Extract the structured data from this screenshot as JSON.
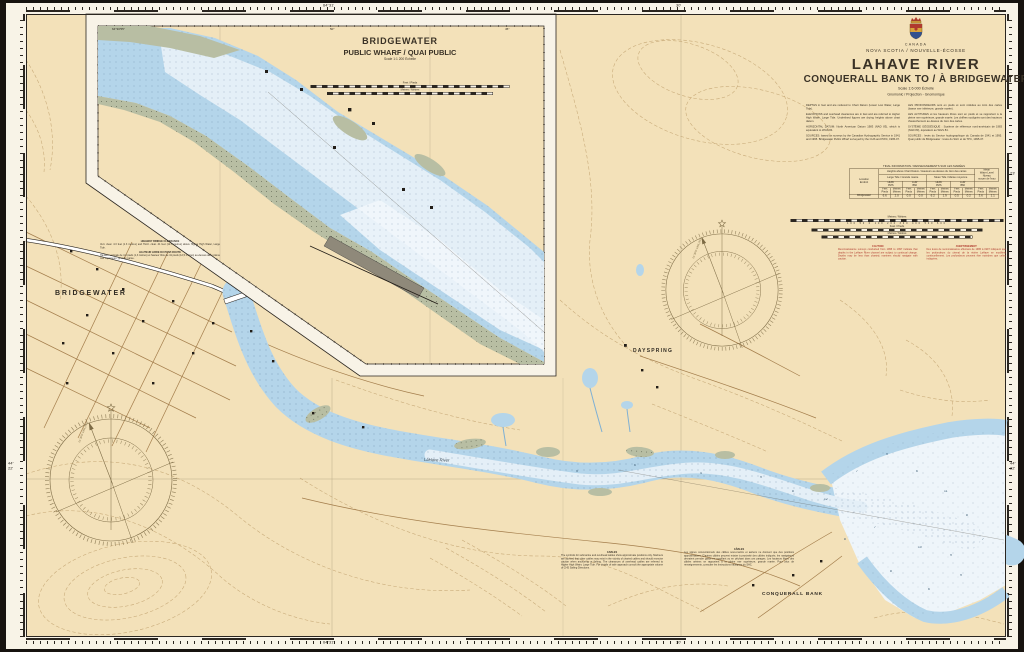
{
  "border": {
    "top_left_lon": "64°31'",
    "top_mid_lon": "30'",
    "bottom_left_lon": "64°31'",
    "bottom_mid_lon": "30'",
    "left_lat": "44°\n22'",
    "right_lat": "44°\n22'",
    "right_lat_upper": "23'"
  },
  "title_block": {
    "country": "CANADA",
    "region": "NOVA SCOTIA / NOUVELLE-ÉCOSSE",
    "title": "LAHAVE RIVER",
    "subtitle": "CONQUERALL BANK TO / À BRIDGEWATER",
    "scale": "Scale 1:6 000 Échelle",
    "projection": "Gnomonic / Projection - Gnomonique",
    "notes_en": [
      "DEPTHS in feet and are reduced to Chart Datum (Lower Low Water, Large Tide).",
      "ELEVATIONS and overhead clearances are in feet and are referred to Higher High Water, Large Tide. Underlined figures are drying heights above chart datum.",
      "HORIZONTAL DATUM: North American Datum 1983 (NAD 83), which is equivalent to WGS 84.",
      "SOURCES: based on surveys by the Canadian Hydrographic Service in 1941 and 1995. Bridgewater Public Wharf surveyed by the CHS and PWC, 1995-07."
    ],
    "notes_fr": [
      "LES PROFONDEURS sont en pieds et sont réduites au zéro des cartes (basse mer inférieure, grande marée).",
      "LES ALTITUDES et les hauteurs libres sont en pieds et se rapportent à la pleine mer supérieure, grande marée. Les chiffres soulignés sont des hauteurs d'assèchement au-dessus du zéro des cartes.",
      "SYSTÈME GÉODÉSIQUE : Système de référence nord-américain de 1983 (NAD 83), équivalent au WGS 84.",
      "SOURCES : levés du Service hydrographique du Canada de 1941 et 1995. Quai public de Bridgewater : levés du SHC et de TPC, 1995-07."
    ]
  },
  "tide": {
    "title": "TIDAL INFORMATION / RENSEIGNEMENTS SUR LES MARÉES",
    "location": "Location\nEndroit",
    "heights": "Heights above Chart Datum / Hauteurs au-dessus du zéro des cartes",
    "large": "Large Tide / Grande marée",
    "mean": "Mean Tide / Marée moyenne",
    "mwl": "Mean\nWater Level\nNiveau\nmoyen de l'eau",
    "hhw": "HHW\nPMS",
    "llw": "LLW\nBMI",
    "feet": "Feet\nPieds",
    "metres": "Metres\nMètres",
    "row": "Bridgewater",
    "values": [
      "6.6",
      "2.0",
      "0.0",
      "0.0",
      "6.2",
      "1.9",
      "0.5",
      "0.2",
      "3.6",
      "1.1"
    ]
  },
  "bars": {
    "b1_label": "Metres / Mètres",
    "b1_ticks": "100 50 0 100 200 300 400 500 600",
    "b2_label": "Feet / Pieds",
    "b2_ticks": "200 0 200 400 600 800 1000 1200 1400",
    "b3_label": "Metres / Mètres",
    "b3_ticks": "50 0 50 100 150 200 250 300"
  },
  "caution": {
    "en_title": "CAUTION",
    "en_body": "Reconnaissance surveys conducted from 1995 to 1997 indicate that depths in the LaHave River channel are subject to continual change. Depths may be less than charted; mariners should navigate with caution.",
    "fr_title": "AVERTISSEMENT",
    "fr_body": "Des levés de reconnaissance effectués de 1995 à 1997 indiquent que les profondeurs du chenal de la rivière LaHave se modifient continuellement. Les profondeurs peuvent être moindres que celles indiquées."
  },
  "cables": {
    "en_title": "CABLES",
    "en_body": "The symbols for submarine and overhead cables show approximate positions only. Mariners are advised that other cables may exist in the vicinity of charted cables and should exercise caution when anchoring or fishing. The clearances of overhead cables are referred to Higher High Water, Large Tide. For details of safe approach consult the appropriate volume of CHS Sailing Directions.",
    "fr_title": "CÂBLES",
    "fr_body": "Les signes conventionnels des câbles sous-marins et aériens ne donnent que des positions approximatives. D'autres câbles peuvent exister à proximité des câbles indiqués; les navigateurs devraient prendre garde en mouillant ou en pêchant dans ces parages. Les hauteurs libres des câbles aériens se rapportent à la pleine mer supérieure, grande marée. Pour plus de renseignements, consulter les Instructions nautiques du SHC."
  },
  "bridge": {
    "en_title": "HIGHWAY BRIDGE CLEARANCE",
    "en_body": "Vert. clear. 4.3 feet (1.3 metres) and Horiz. clear. 41 feet (12.5 metres) above Higher High Water, Large Tide.",
    "fr_title": "HAUTEUR LIBRE DU PONT-ROUTE",
    "fr_body": "Hauteur verticale de 4,3 pieds (1,3 mètres) et hauteur libre de 41 pieds (12,5 mètres) au-dessus de la pleine mer supérieure, grande marée."
  },
  "inset": {
    "title": "BRIDGEWATER",
    "subtitle": "PUBLIC WHARF / QUAI PUBLIC",
    "scale": "Scale 1:1 200 Échelle",
    "feet_label": "Feet / Pieds",
    "feet_ticks": "50 0 50 100 150 200 250",
    "metres_label": "Metres / Mètres",
    "metres_ticks": "10 0 10 20 30 40 50 60 70 80",
    "grad": [
      "64°30'55\"",
      "50\"",
      "45\""
    ]
  },
  "places": {
    "bridgewater": "BRIDGEWATER",
    "dayspring": "DAYSPRING",
    "conquerall": "CONQUERALL BANK",
    "river": "LaHave River"
  },
  "compass": {
    "variation": "21°30'W 1995 (8'E)"
  },
  "soundings": [
    "9",
    "8",
    "12",
    "7",
    "9",
    "6",
    "11",
    "8",
    "7",
    "9",
    "10",
    "8",
    "6",
    "9",
    "7",
    "8",
    "5",
    "6",
    "4"
  ]
}
